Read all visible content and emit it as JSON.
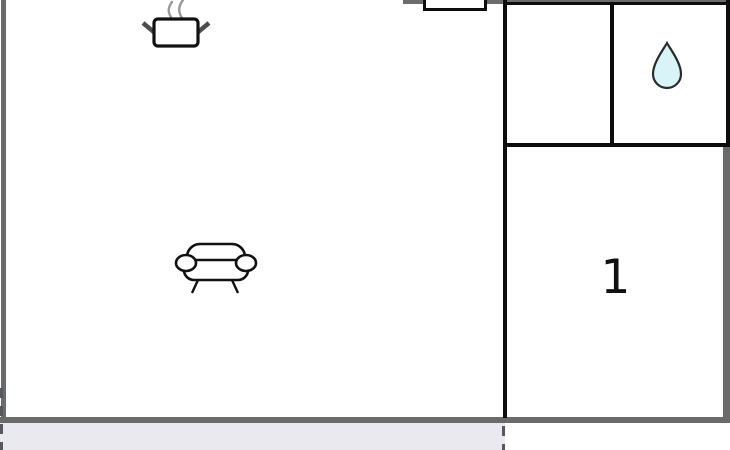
{
  "floorplan": {
    "bedroom_label": "1",
    "icons": {
      "kitchen": "cooking-pot-icon",
      "living_room": "sofa-icon",
      "bathroom": "water-droplet-icon"
    },
    "colors": {
      "outer_wall": "#6b6b6b",
      "inner_wall": "#0d0d0d",
      "terrace_fill": "#e9e9ef",
      "terrace_dash": "#55585c",
      "droplet_fill": "#d8f4f8",
      "droplet_stroke": "#2b2b2b",
      "icon_stroke": "#111111",
      "steam_gray": "#999999",
      "handle_gray": "#4d4d4d"
    }
  }
}
